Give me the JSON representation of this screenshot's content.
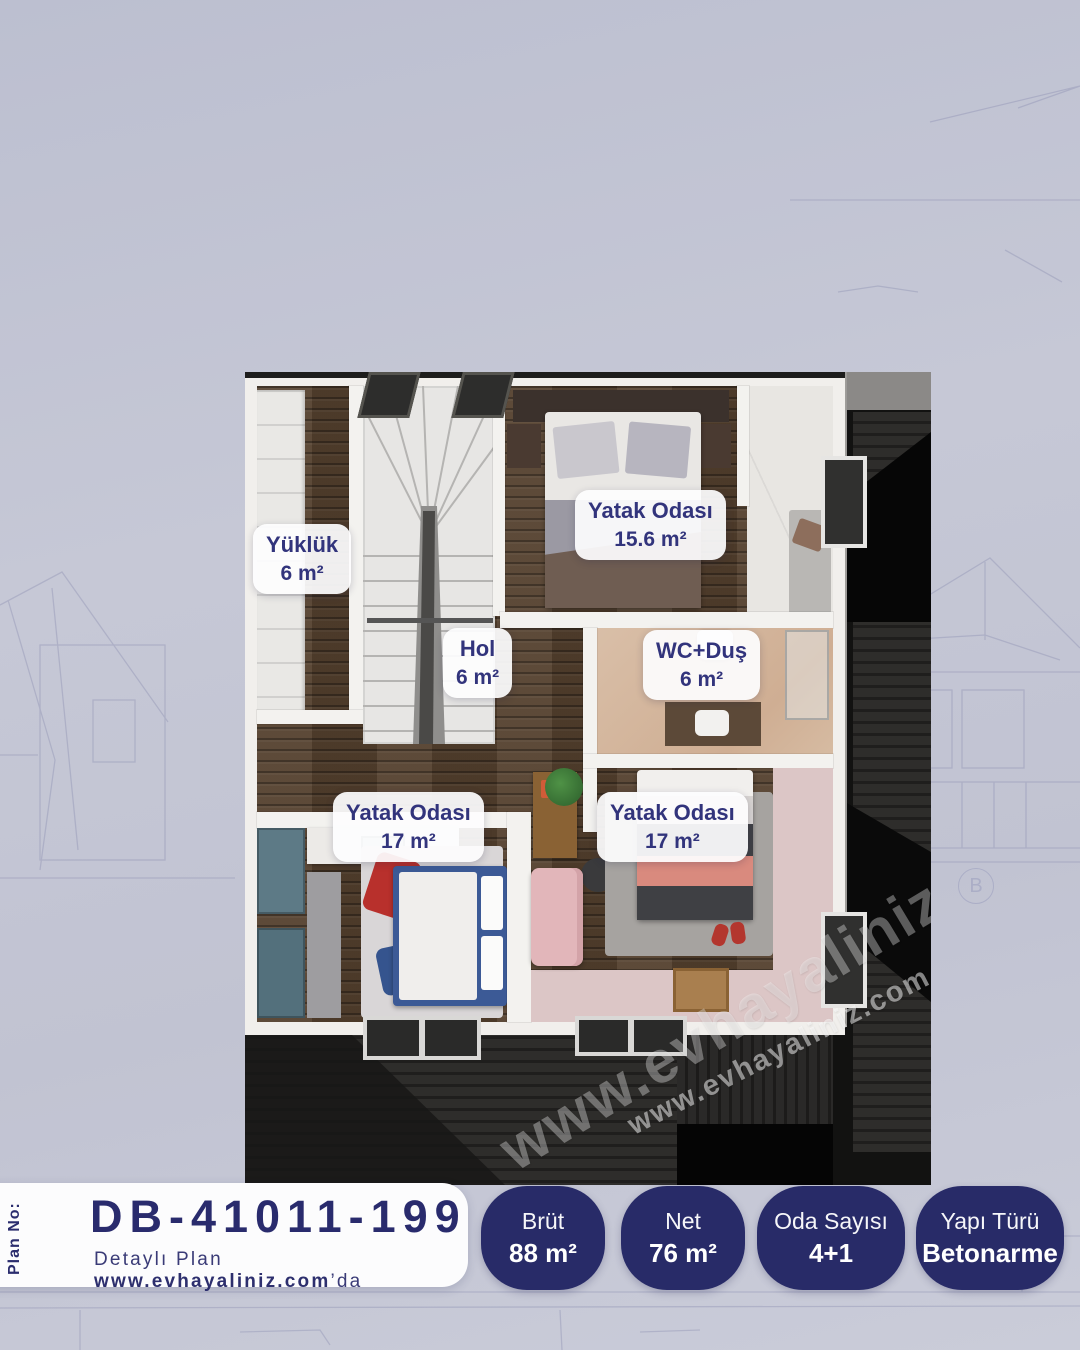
{
  "plan_card": {
    "plan_no_label": "Plan No:",
    "plan_code": "DB-41011-199",
    "detail_prefix": "Detaylı Plan ",
    "detail_site": "www.evhayaliniz.com",
    "detail_suffix": "’da"
  },
  "badges": [
    {
      "label": "Brüt",
      "value": "88 m²"
    },
    {
      "label": "Net",
      "value": "76 m²"
    },
    {
      "label": "Oda Sayısı",
      "value": "4+1"
    },
    {
      "label": "Yapı Türü",
      "value": "Betonarme"
    }
  ],
  "rooms": [
    {
      "name": "Yüklük",
      "area": "6 m²"
    },
    {
      "name": "Yatak Odası",
      "area": "15.6 m²"
    },
    {
      "name": "Hol",
      "area": "6 m²"
    },
    {
      "name": "WC+Duş",
      "area": "6 m²"
    },
    {
      "name": "Yatak Odası",
      "area": "17 m²"
    },
    {
      "name": "Yatak Odası",
      "area": "17 m²"
    }
  ],
  "watermarks": {
    "large": "www.evhayaliniz.com",
    "small": "www.evhayaliniz.com.tr"
  },
  "background_sketch": {
    "marker": "B"
  },
  "colors": {
    "background": "#c4c6d5",
    "badge_navy": "#282b68",
    "text_navy": "#2b2d6e",
    "label_text": "#32347c",
    "card_white": "#fcfcfd",
    "wood_floor": "#54402e",
    "roof_dark": "#2a2928",
    "wc_tile": "#d5b9a2",
    "pink_floor": "#dcc6c6"
  }
}
